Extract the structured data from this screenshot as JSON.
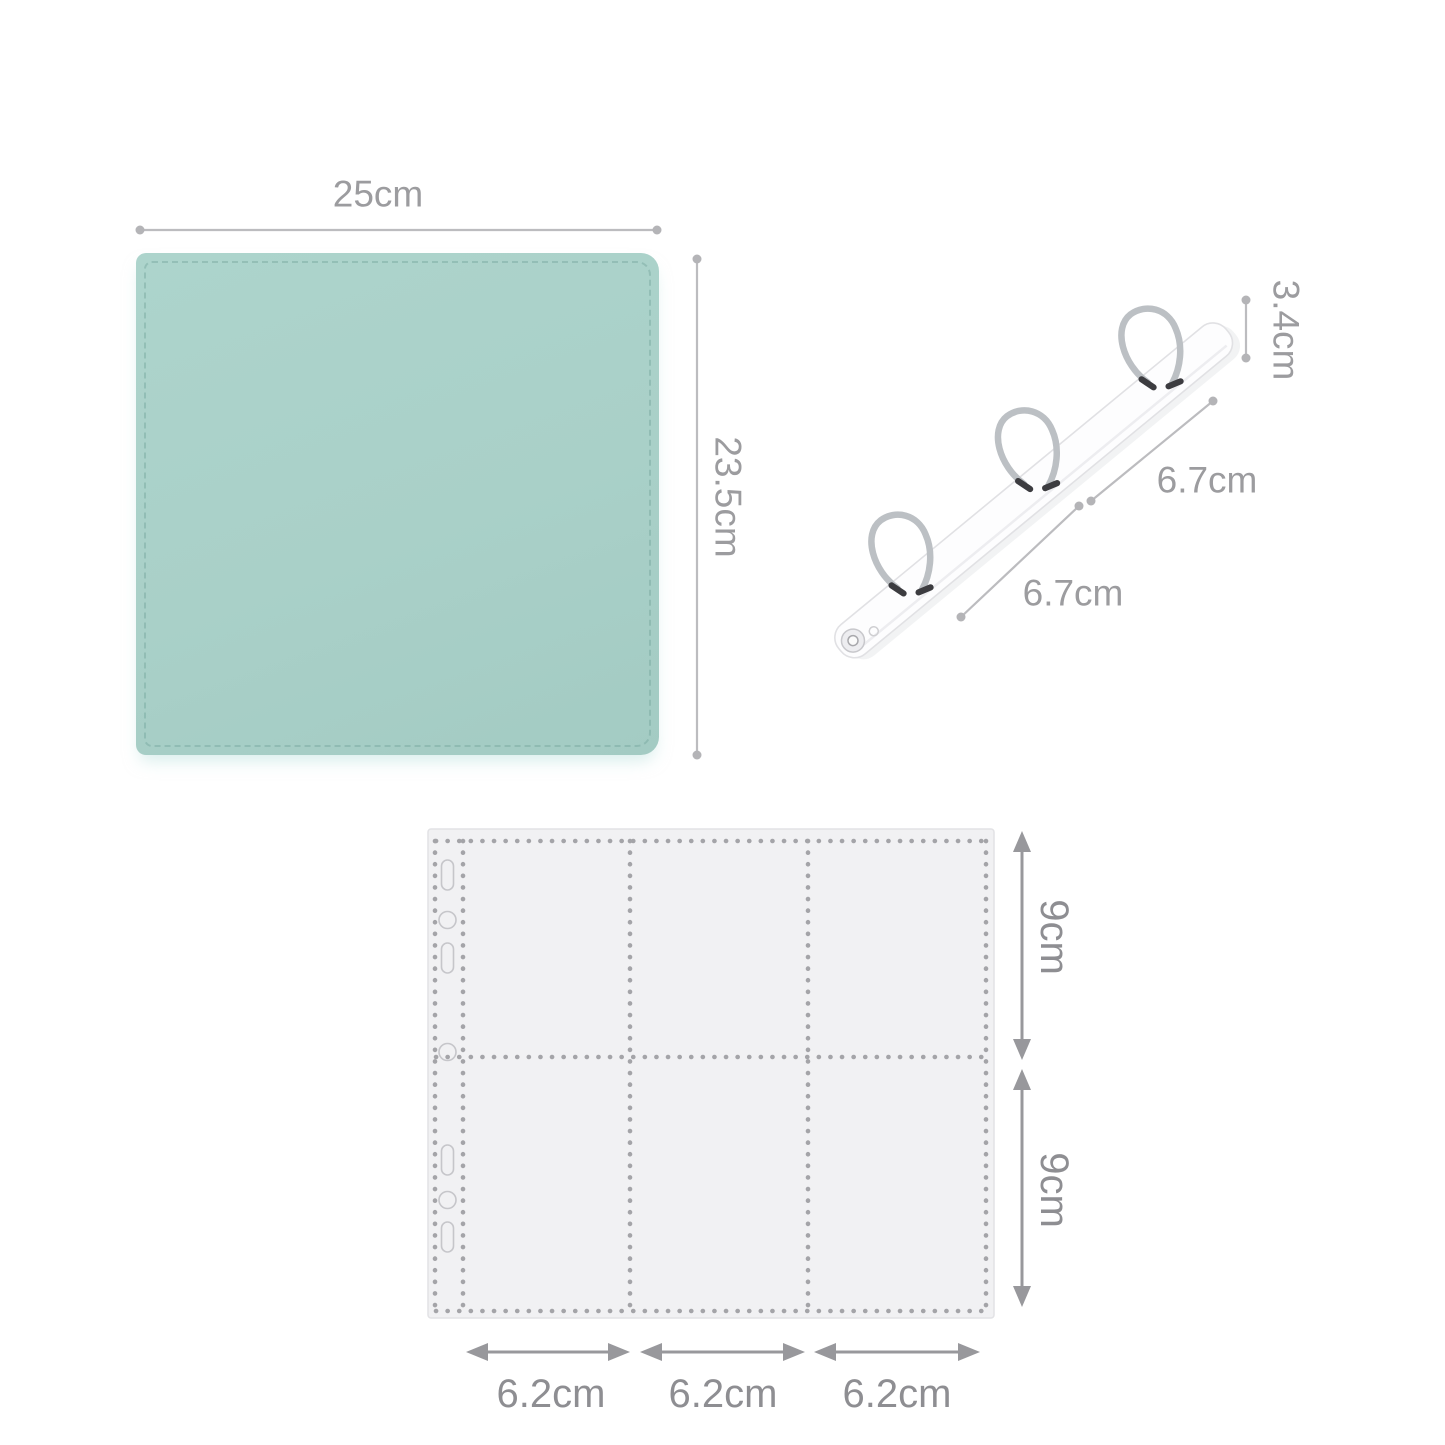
{
  "page": {
    "background": "#ffffff"
  },
  "binder": {
    "width_label": "25cm",
    "height_label": "23.5cm",
    "cover_color": "#a9d0c8"
  },
  "ring_mechanism": {
    "height_label": "3.4cm",
    "gap_upper_label": "6.7cm",
    "gap_lower_label": "6.7cm",
    "ring_count": 3,
    "metal_color": "#bcc0c4"
  },
  "pocket_page": {
    "rows": 2,
    "columns": 3,
    "row_top_label": "9cm",
    "row_bottom_label": "9cm",
    "col_labels": [
      "6.2cm",
      "6.2cm",
      "6.2cm"
    ],
    "fill_color": "#f1f1f3",
    "stitch_color": "#a4a4a8"
  },
  "dimension_style": {
    "line_color": "#bcbcbf",
    "dot_color": "#b4b4b7",
    "text_color_top": "#9c9c9f",
    "text_color_bottom": "#8e8e92",
    "arrow_color": "#98989c"
  }
}
